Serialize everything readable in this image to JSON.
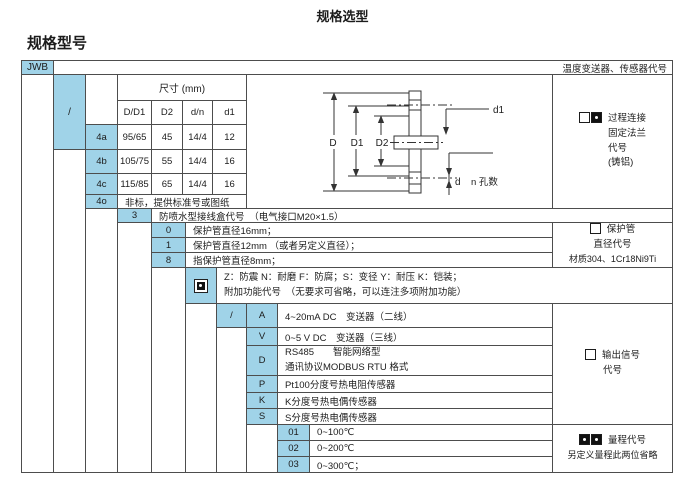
{
  "page": {
    "title": "规格选型",
    "section_heading": "规格型号"
  },
  "colors": {
    "cell_blue": "#a0d3e8",
    "border": "#4d4d4d",
    "text": "#1c1c1c"
  },
  "table": {
    "model_code": "JWB",
    "header_right": "温度变送器、传感器代号",
    "flange": {
      "slash": "/",
      "dim_title": "尺寸 (mm)",
      "dim_cols": [
        "D/D1",
        "D2",
        "d/n",
        "d1"
      ],
      "rows": [
        {
          "code": "4a",
          "values": [
            "95/65",
            "45",
            "14/4",
            "12"
          ]
        },
        {
          "code": "4b",
          "values": [
            "105/75",
            "55",
            "14/4",
            "16"
          ]
        },
        {
          "code": "4c",
          "values": [
            "115/85",
            "65",
            "14/4",
            "16"
          ]
        }
      ],
      "nonstandard": {
        "code": "4o",
        "text": "非标，提供标准号或图纸"
      }
    },
    "junction_box": {
      "code": "3",
      "text": "防喷水型接线盒代号　（电气接口M20×1.5）"
    },
    "protect_tube": {
      "options": [
        {
          "code": "0",
          "text": "保护管直径16mm；"
        },
        {
          "code": "1",
          "text": "保护管直径12mm （或者另定义直径）；"
        },
        {
          "code": "8",
          "text": "指保护管直径8mm；"
        }
      ]
    },
    "addon": {
      "line1": "Z：防震 N：耐磨 F：防腐；S：变径 Y：耐压 K：铠装；",
      "line2": "附加功能代号　（无要求可省略，可以连注多项附加功能）"
    },
    "output": {
      "slash": "/",
      "options": [
        {
          "code": "A",
          "text": "4~20mA DC　变送器（二线）"
        },
        {
          "code": "V",
          "text": "0~5 V DC　变送器（三线）"
        },
        {
          "code": "D",
          "text": "RS485　　智能网络型",
          "text2": "通讯协议MODBUS RTU 格式"
        },
        {
          "code": "P",
          "text": "Pt100分度号热电阻传感器"
        },
        {
          "code": "K",
          "text": "K分度号热电偶传感器"
        },
        {
          "code": "S",
          "text": "S分度号热电偶传感器"
        }
      ]
    },
    "range": {
      "options": [
        {
          "code": "01",
          "text": "0~100℃"
        },
        {
          "code": "02",
          "text": "0~200℃"
        },
        {
          "code": "03",
          "text": "0~300℃；"
        }
      ]
    },
    "legend": {
      "process_connection": {
        "l1": "过程连接",
        "l2": "固定法兰",
        "l3": "代号",
        "l4": "(铸铝)"
      },
      "protect_tube": {
        "l1": "保护管",
        "l2": "直径代号",
        "l3": "材质304、1Cr18Ni9Ti"
      },
      "output_signal": {
        "l1": "输出信号",
        "l2": "代号"
      },
      "range": {
        "l1": "量程代号",
        "l2": "另定义量程此两位省略"
      }
    },
    "drawing": {
      "labels": {
        "D": "D",
        "D1": "D1",
        "D2": "D2",
        "d1": "d1",
        "d": "d",
        "n": "n 孔数"
      }
    }
  }
}
